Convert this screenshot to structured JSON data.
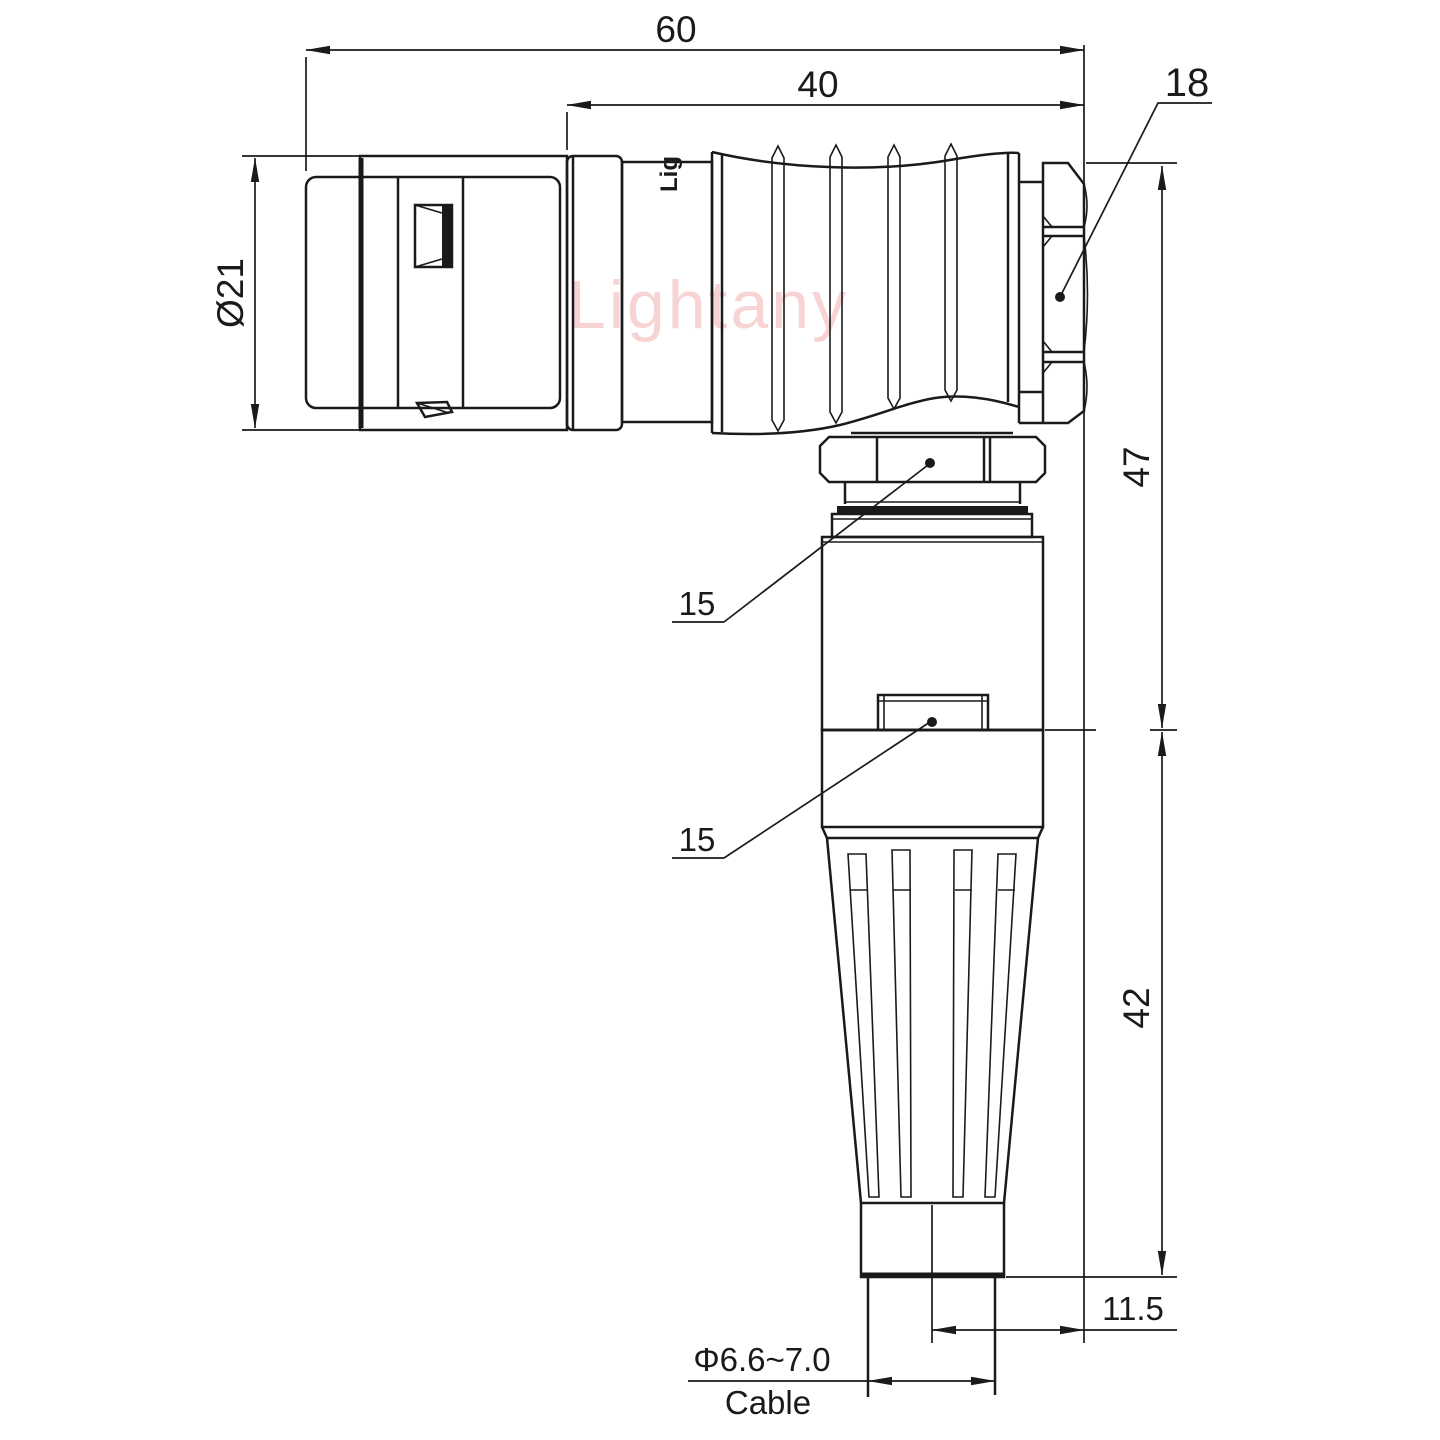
{
  "watermark": {
    "text": "Lightany"
  },
  "marking": {
    "text": "Lig"
  },
  "colors": {
    "line": "#1a1a1a",
    "watermark": "#f6c9c9",
    "background": "#ffffff"
  },
  "dims": {
    "overall": {
      "value": "60"
    },
    "rear": {
      "value": "40"
    },
    "nut": {
      "value": "18"
    },
    "diameter": {
      "value": "Ø21"
    },
    "upper_height": {
      "value": "47"
    },
    "lower_height": {
      "value": "42"
    },
    "offset": {
      "value": "11.5"
    },
    "hex_nut": {
      "value": "15"
    },
    "hex_body": {
      "value": "15"
    },
    "cable_dia": {
      "value": "Φ6.6~7.0"
    },
    "cable_label": {
      "value": "Cable"
    }
  }
}
